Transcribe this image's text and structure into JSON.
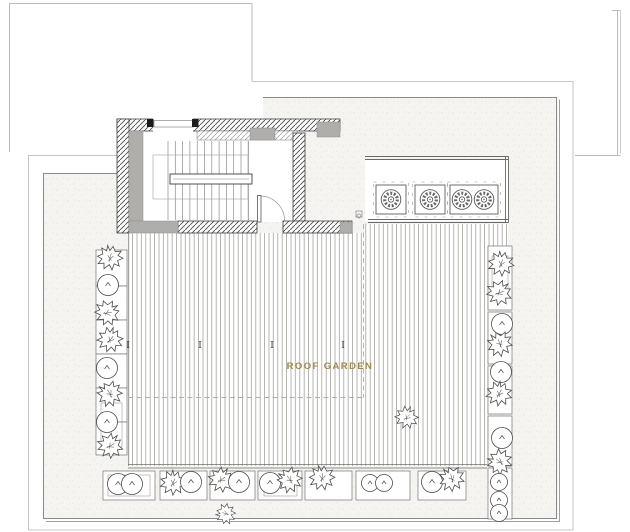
{
  "plan": {
    "label": "ROOF GARDEN",
    "label_color": "#a1894e",
    "section_markers": [
      "I",
      "I",
      "I",
      "I"
    ],
    "colors": {
      "paper": "#ffffff",
      "stipple_bg": "#f5f4f1",
      "stipple_dot": "#d6d4d0",
      "outline_light": "#c7c5c2",
      "outline_dark": "#8b8987",
      "wall_hatch": "#4a4a4a",
      "wall_gray": "#b0aeab",
      "deck_line": "#98968f",
      "plant_line": "#4e4c49",
      "label_gold": "#a1894e"
    }
  }
}
